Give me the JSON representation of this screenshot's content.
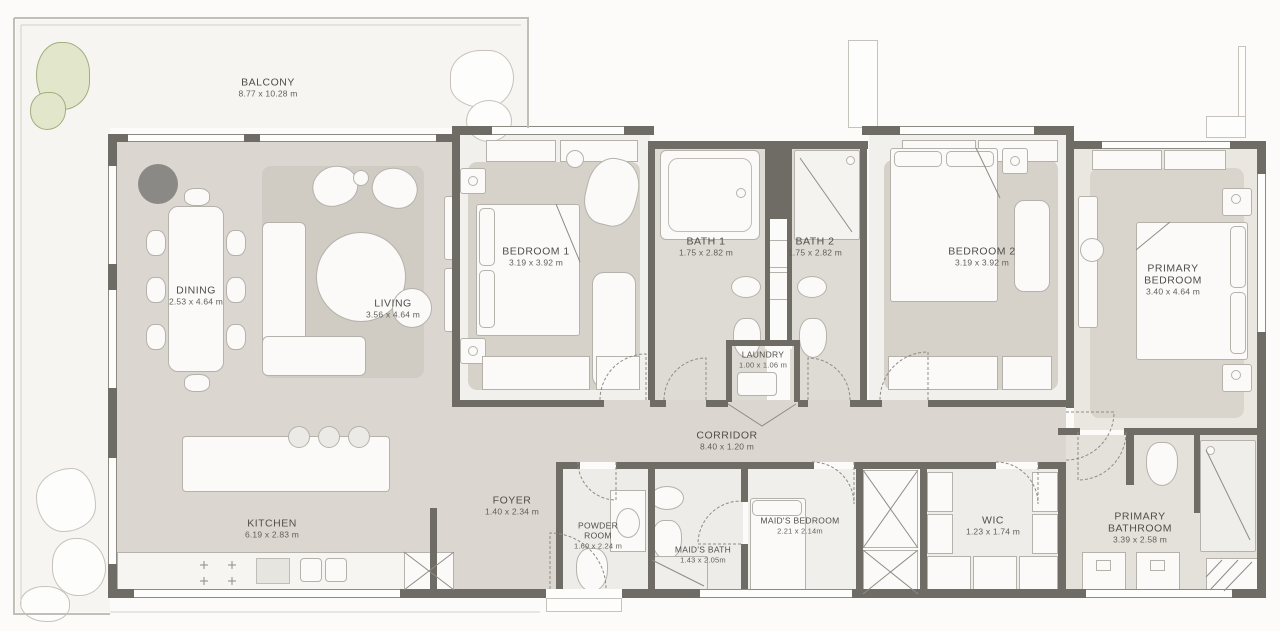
{
  "plan": {
    "title": "Apartment floor plan",
    "rooms": {
      "balcony": {
        "name": "BALCONY",
        "dims": "8.77 x 10.28 m"
      },
      "dining": {
        "name": "DINING",
        "dims": "2.53 x 4.64 m"
      },
      "living": {
        "name": "LIVING",
        "dims": "3.56 x 4.64 m"
      },
      "bedroom1": {
        "name": "BEDROOM 1",
        "dims": "3.19 x 3.92 m"
      },
      "bath1": {
        "name": "BATH 1",
        "dims": "1.75 x 2.82 m"
      },
      "bath2": {
        "name": "BATH 2",
        "dims": "1.75 x 2.82 m"
      },
      "bedroom2": {
        "name": "BEDROOM 2",
        "dims": "3.19 x 3.92 m"
      },
      "primary_bedroom": {
        "name": "PRIMARY BEDROOM",
        "dims": "3.40 x 4.64 m"
      },
      "laundry": {
        "name": "LAUNDRY",
        "dims": "1.00 x 1.06 m"
      },
      "corridor": {
        "name": "CORRIDOR",
        "dims": "8.40 x 1.20 m"
      },
      "kitchen": {
        "name": "KITCHEN",
        "dims": "6.19 x 2.83 m"
      },
      "foyer": {
        "name": "FOYER",
        "dims": "1.40 x 2.34 m"
      },
      "powder_room": {
        "name": "POWDER ROOM",
        "dims": "1.60 x 2.24 m"
      },
      "maids_bath": {
        "name": "MAID'S BATH",
        "dims": "1.43 x 2.05m"
      },
      "maids_bedroom": {
        "name": "MAID'S BEDROOM",
        "dims": "2.21 x 2.14m"
      },
      "wic": {
        "name": "WIC",
        "dims": "1.23 x 1.74 m"
      },
      "primary_bathroom": {
        "name": "PRIMARY BATHROOM",
        "dims": "3.39 x 2.58 m"
      }
    },
    "colors": {
      "wall": "#6f6c66",
      "open_floor": "#dbd7d0",
      "room_floor": "#f2f0ec",
      "bath_floor": "#dedbd4",
      "rug": "#d6d2ca",
      "balcony_floor": "#f6f5f2",
      "balcony_outline": "#c2bfb9",
      "tree_fill": "#e2e7cb",
      "tree_edge": "#a3ad7e",
      "planter": "#8b8985",
      "label_text": "#504e4a"
    }
  }
}
